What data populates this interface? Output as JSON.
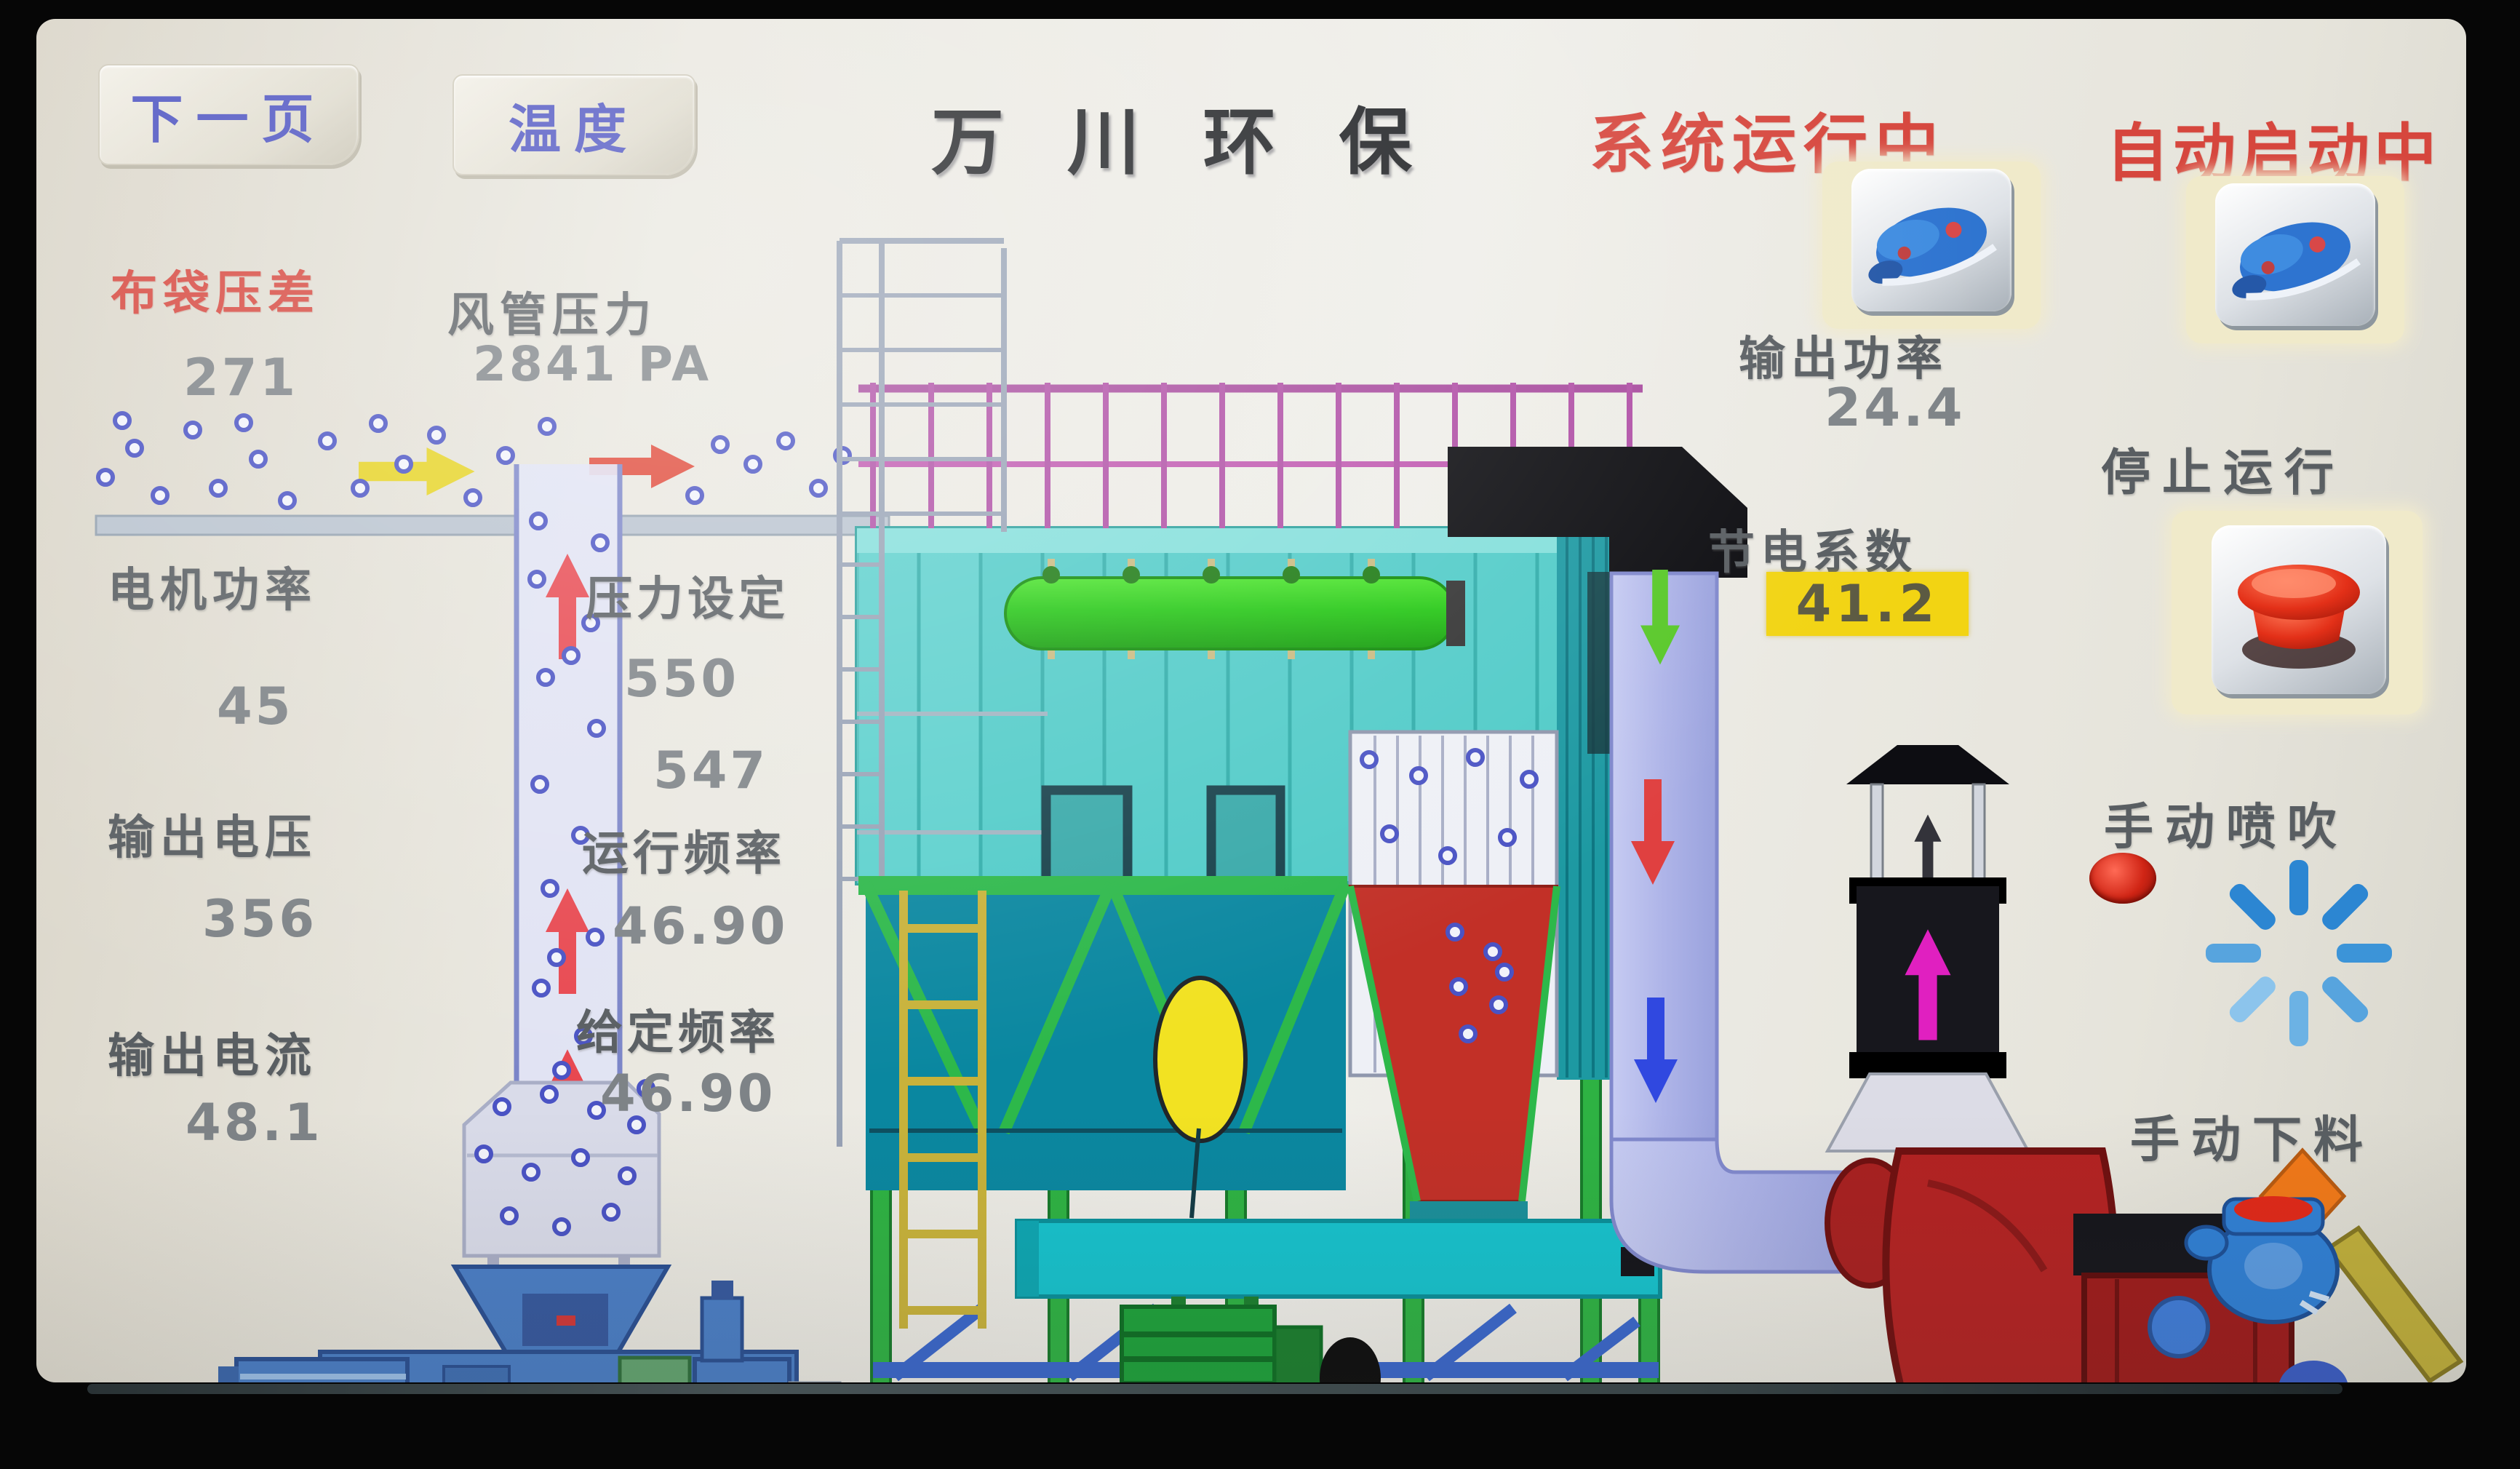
{
  "header": {
    "next_page_button": "下一页",
    "temperature_button": "温度",
    "title": "万 川 环 保",
    "system_status": "系统运行中",
    "auto_status": "自动启动中"
  },
  "readings": {
    "bag_pressure_diff": {
      "label": "布袋压差",
      "value": "271"
    },
    "duct_pressure": {
      "label": "风管压力",
      "value": "2841 PA"
    },
    "motor_power": {
      "label": "电机功率",
      "value": "45"
    },
    "pressure_setting": {
      "label": "压力设定",
      "value": "550",
      "value2": "547"
    },
    "output_voltage": {
      "label": "输出电压",
      "value": "356"
    },
    "run_frequency": {
      "label": "运行频率",
      "value": "46.90"
    },
    "output_current": {
      "label": "输出电流",
      "value": "48.1"
    },
    "set_frequency": {
      "label": "给定频率",
      "value": "46.90"
    }
  },
  "right_panel": {
    "output_power_label": "输出功率",
    "output_power_value": "24.4",
    "saving_factor_label": "节电系数",
    "saving_factor_value": "41.2",
    "stop_label": "停止运行",
    "manual_blow_label": "手动喷吹",
    "manual_discharge_label": "手动下料"
  },
  "icons": {
    "run_pump_button": "pump-icon",
    "auto_pump_button": "pump-icon",
    "stop_button": "emergency-stop-icon",
    "blow_indicator": "led-indicator-icon",
    "blow_spinner": "spray-spinner-icon",
    "discharge_valve": "rotary-valve-icon"
  },
  "colors": {
    "status_red": "#d6463d",
    "button_text_blue": "#4a50c0",
    "highlight_yellow": "#f2d413",
    "baghouse_teal": "#50cbc8",
    "structure_green": "#2db843",
    "exhaust_lavender": "#b6bcec",
    "fan_red": "#b32222"
  }
}
